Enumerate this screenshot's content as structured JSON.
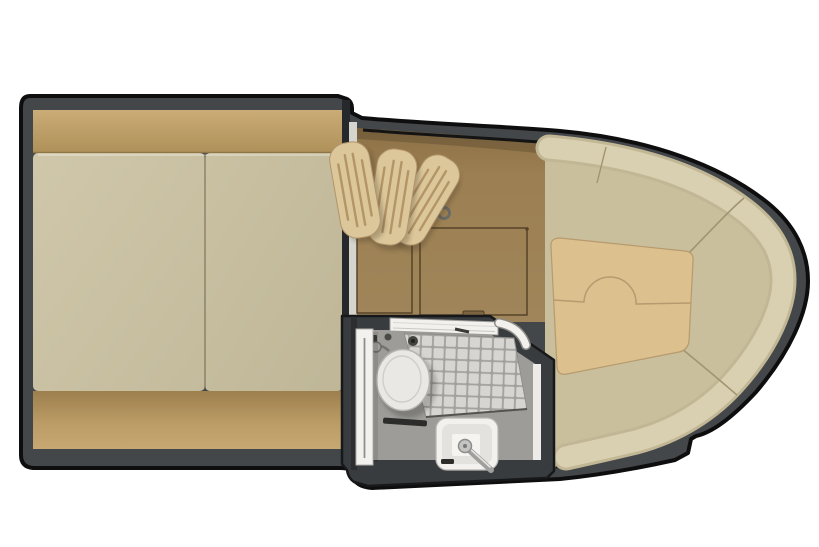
{
  "canvas": {
    "width": 819,
    "height": 547,
    "background": "#ffffff"
  },
  "palette": {
    "outline": "#0e0e0f",
    "hull_wall": "#44474a",
    "bath_wall": "#393c3f",
    "divider_dark": "#26282b",
    "divider_top": "#d6d4cf",
    "headboard": "#bda068",
    "mattress_left": "#ccc3a5",
    "mattress_right": "#c5bc9e",
    "footboard": "#b5945f",
    "cabin_floor": "#9c8053",
    "hatch_line": "#564328",
    "table_leaf": "#dcc79a",
    "leaf_groove": "#ad8d5f",
    "leaf_edge": "#b2946a",
    "bench": "#c9bf9d",
    "backrest_edge": "#c2b795",
    "backrest": "#d9d0b2",
    "seam": "#a1956f",
    "lounge_cushion": "#dcc08e",
    "cushion_edge": "#b79a6e",
    "bath_floor": "#9d9c98",
    "tile": "#d6d5d1",
    "grout": "#a2a19d",
    "fixture_white": "#f2f1ee",
    "porcelain": "#e9e8e4",
    "metal": "#9f9f9d",
    "dark_detail": "#2c2c2a",
    "inner_hull_line": "#141414"
  },
  "plan": {
    "areas": [
      {
        "id": "berth",
        "mattress_count": 2
      },
      {
        "id": "mid-cabin",
        "table_leaf_count": 3,
        "floor_hatch_count": 2
      },
      {
        "id": "bow-lounge",
        "cushion_seam_notch": "semicircle"
      },
      {
        "id": "head",
        "fixtures": [
          "toilet",
          "shower-tile-floor",
          "shower-drain",
          "sink",
          "faucet",
          "sliding-door",
          "door-track"
        ]
      }
    ]
  }
}
